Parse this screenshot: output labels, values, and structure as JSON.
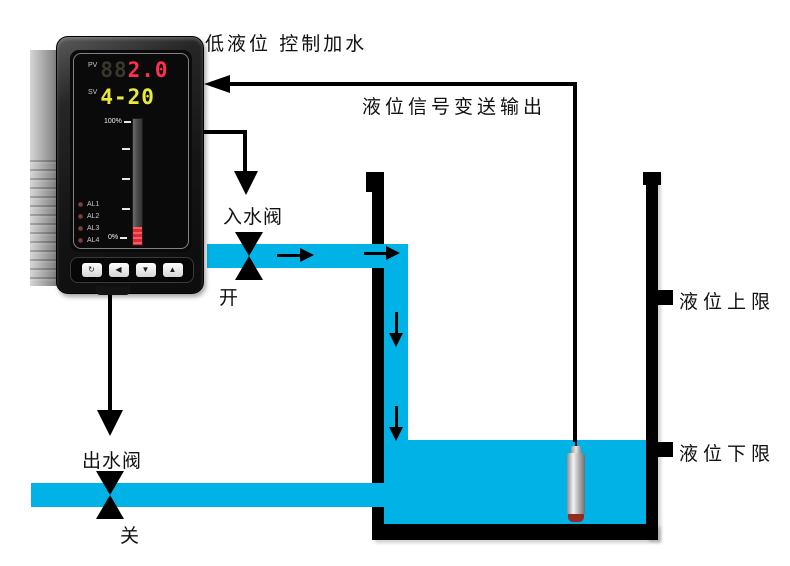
{
  "labels": {
    "title": "低液位 控制加水",
    "signal": "液位信号变送输出",
    "inlet_valve": "入水阀",
    "inlet_state": "开",
    "outlet_valve": "出水阀",
    "outlet_state": "关",
    "upper_limit": "液位上限",
    "lower_limit": "液位下限"
  },
  "instrument": {
    "pv_label": "PV",
    "pv_ghost": "88",
    "pv_value": "2.0",
    "sv_label": "SV",
    "sv_value": "4-20",
    "bar_top": "100%",
    "bar_bottom": "0%",
    "leds": [
      "AL1",
      "AL2",
      "AL3",
      "AL4"
    ],
    "buttons": [
      "↻",
      "◀",
      "▼",
      "▲"
    ]
  },
  "colors": {
    "water": "#00b2e6",
    "line": "#000000",
    "pv_display": "#ff2f52",
    "sv_display": "#e9e93c",
    "bar_fill": "#d92b38"
  }
}
